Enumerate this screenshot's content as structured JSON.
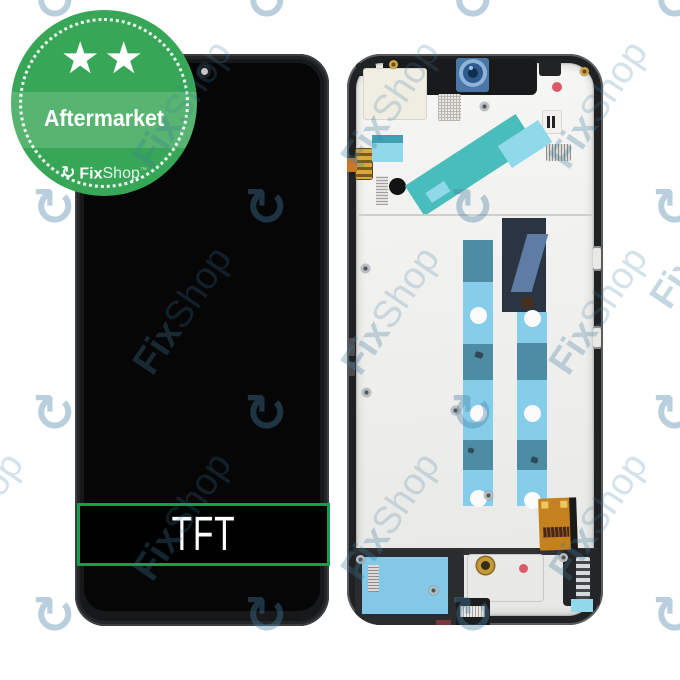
{
  "badge": {
    "stars": "★★",
    "label": "Aftermarket",
    "icon": "↻",
    "brand_bold": "Fix",
    "brand_light": "Shop",
    "tm": "™"
  },
  "product": {
    "panel_label": "TFT"
  },
  "watermark": {
    "icon": "↻",
    "brand_bold": "Fix",
    "brand_light": "Shop"
  },
  "colors": {
    "badge_green": "#37a656",
    "badge_band": "rgba(255,255,255,0.16)",
    "tft_border_green": "#13a04b",
    "marker_red": "#dc5a68",
    "camera_blue": "#4e7cb0",
    "tape_teal": "#49bcbc",
    "tape_cyan": "#8fd9ea",
    "adhesive_steel_blue": "#4e8ba4",
    "adhesive_light_blue": "#86cdea",
    "speaker_adhesive_blue": "#84c7e6",
    "flex_orange": "#c5811f"
  }
}
